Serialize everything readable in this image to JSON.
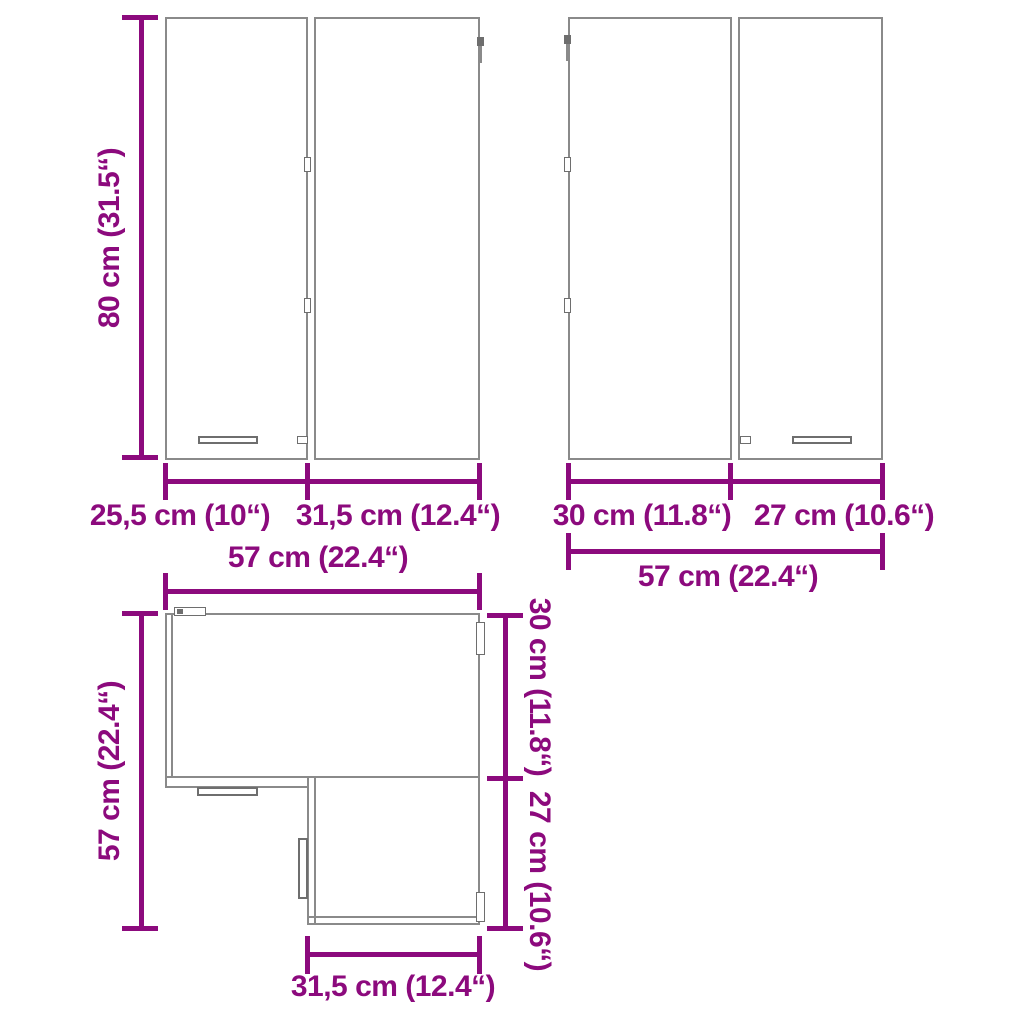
{
  "colors": {
    "dimension": "#8C0A7D",
    "outline": "#8A8A8A",
    "detail": "#6E6E6E",
    "background": "#FFFFFF"
  },
  "front_left": {
    "height_label": "80 cm (31.5“)",
    "door_left_width_label": "25,5 cm (10“)",
    "door_right_width_label": "31,5 cm (12.4“)"
  },
  "front_right": {
    "door_left_width_label": "30 cm (11.8“)",
    "door_right_width_label": "27 cm (10.6“)",
    "total_width_label": "57 cm (22.4“)"
  },
  "top_view": {
    "top_width_label": "57 cm (22.4“)",
    "left_depth_label": "57 cm (22.4“)",
    "right_upper_depth_label": "30 cm (11.8“)",
    "right_lower_depth_label": "27 cm (10.6“)",
    "bottom_width_label": "31,5 cm (12.4“)"
  }
}
